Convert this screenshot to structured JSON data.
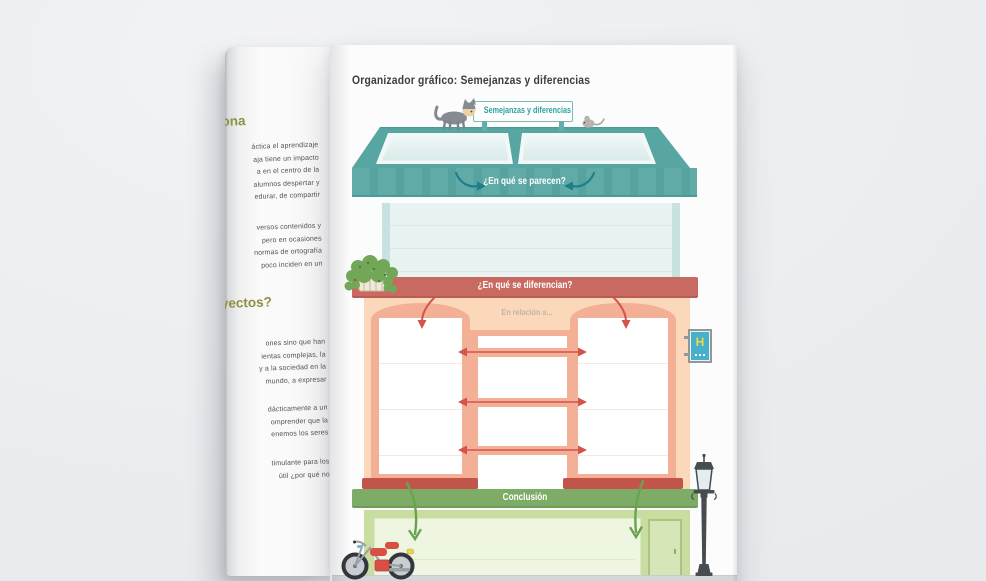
{
  "page": {
    "title": "Organizador gráfico: Semejanzas y diferencias"
  },
  "organizer": {
    "sign": "Semejanzas y diferencias",
    "similarities_question": "¿En qué se parecen?",
    "differences_question": "¿En qué se diferencian?",
    "relation_prompt": "En relación a...",
    "conclusion": "Conclusión",
    "hotel_sign": "H"
  },
  "left_page": {
    "heading_top": "ona",
    "heading_mid": "yectos?",
    "para1": [
      "áctica el aprendizaje",
      "aja tiene un impacto",
      "a en el centro de la",
      "alumnos despertar y",
      "edurar, de compartir"
    ],
    "para2": [
      "versos contenidos y",
      "pero en ocasiones",
      "normas de ortografía",
      "poco inciden en un"
    ],
    "para3": [
      "ones sino que han",
      "ientas complejas, la",
      "y a la sociedad en la",
      "mundo, a expresar"
    ],
    "para4": [
      "dácticamente a un",
      "omprender que la",
      "enemos los seres"
    ],
    "para5": [
      "timulante para los",
      "útil ¿por qué no"
    ]
  },
  "illustrations": [
    "cat",
    "mouse",
    "hanging-plant",
    "hotel-sign",
    "street-lamp",
    "moped",
    "skylight-windows"
  ],
  "colors": {
    "background": "#ebedf0",
    "roof_teal": "#58a7a3",
    "arrow_teal": "#1f7e8a",
    "cornice_red": "#c96a62",
    "arrow_red": "#d3544b",
    "wall_peach": "#fcd8ba",
    "panel_salmon": "#f3b096",
    "sill_dark_red": "#c2544b",
    "cornice_green": "#7dac67",
    "storefront_green": "#c9dda1",
    "arrow_green": "#69a350",
    "heading_olive": "#8e9140",
    "hotel_blue": "#47b0ca",
    "hotel_yellow": "#f6d742"
  }
}
